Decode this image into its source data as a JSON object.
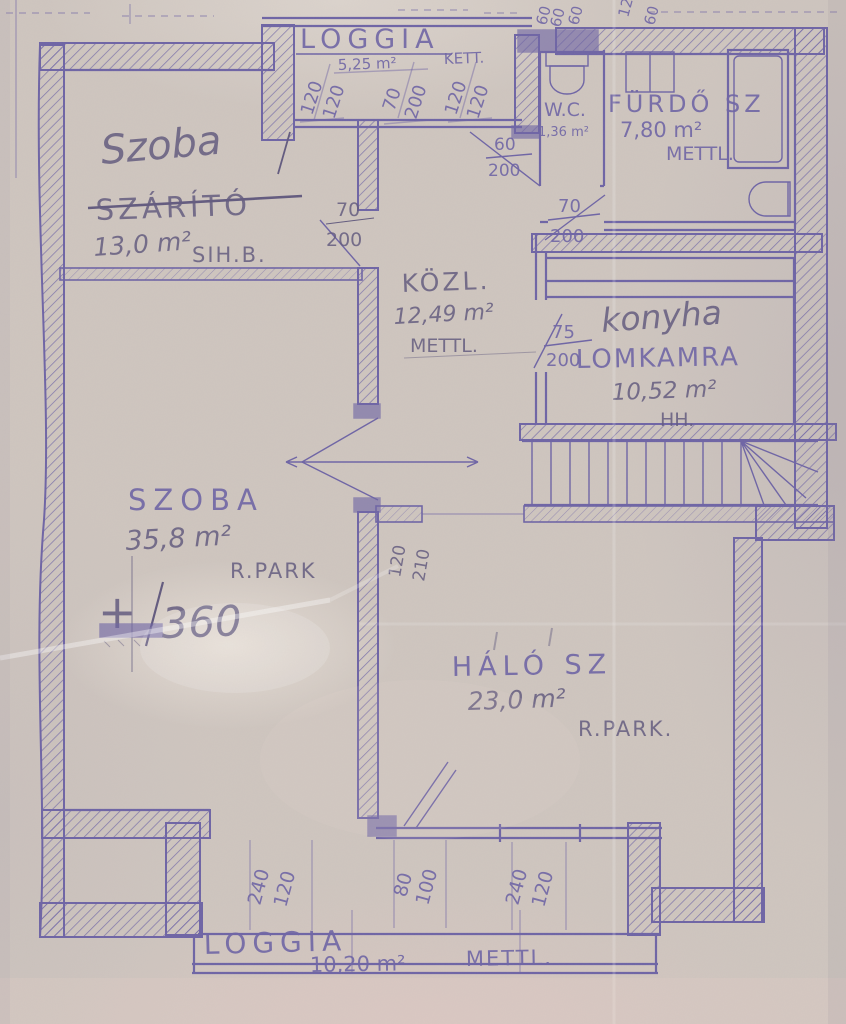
{
  "rooms": {
    "loggia_top": {
      "name": "LOGGIA",
      "area": "5,25 m²",
      "floor": "KETT."
    },
    "szarito": {
      "name_hand": "Szoba",
      "name_orig": "SZÁRÍTÓ",
      "area": "13,0 m²",
      "note": "SIH.B."
    },
    "wc": {
      "name": "W.C.",
      "area": "1,36 m²"
    },
    "furdo": {
      "name": "FÜRDŐ SZ",
      "area": "7,80 m²",
      "floor": "METTL."
    },
    "kozl": {
      "name": "KÖZL.",
      "area": "12,49 m²",
      "floor": "METTL."
    },
    "konyha": {
      "name_hand": "konyha",
      "name_orig": "LOMKAMRA",
      "area": "10,52 m²",
      "floor": "HH."
    },
    "szoba": {
      "name": "SZOBA",
      "area": "35,8 m²",
      "floor": "R.PARK"
    },
    "halo": {
      "name": "HÁLÓ SZ",
      "area": "23,0 m²",
      "floor": "R.PARK."
    },
    "loggia_bottom": {
      "name": "LOGGIA",
      "area": "10,20 m²",
      "floor": "METTL."
    }
  },
  "level_mark": {
    "sign": "+",
    "value": "360"
  },
  "dims": {
    "top_edge": [
      "60",
      "60",
      "60",
      "12",
      "60"
    ],
    "loggia_top": [
      [
        "120",
        "120"
      ],
      [
        "70",
        "200"
      ],
      [
        "120",
        "120"
      ]
    ],
    "szarito_door": [
      "70",
      "200"
    ],
    "wc_door": [
      "60",
      "200"
    ],
    "furdo_door": [
      "70",
      "200"
    ],
    "konyha_door": [
      "75",
      "200"
    ],
    "halo_door": [
      "120",
      "210"
    ],
    "bottom": [
      [
        "240",
        "120"
      ],
      [
        "80",
        "100"
      ],
      [
        "240",
        "120"
      ]
    ]
  },
  "colors": {
    "paper": "#cfc6bf",
    "ink": "#6e64a5",
    "ink_dark": "#5d53a0",
    "pencil": "#625a7e"
  }
}
